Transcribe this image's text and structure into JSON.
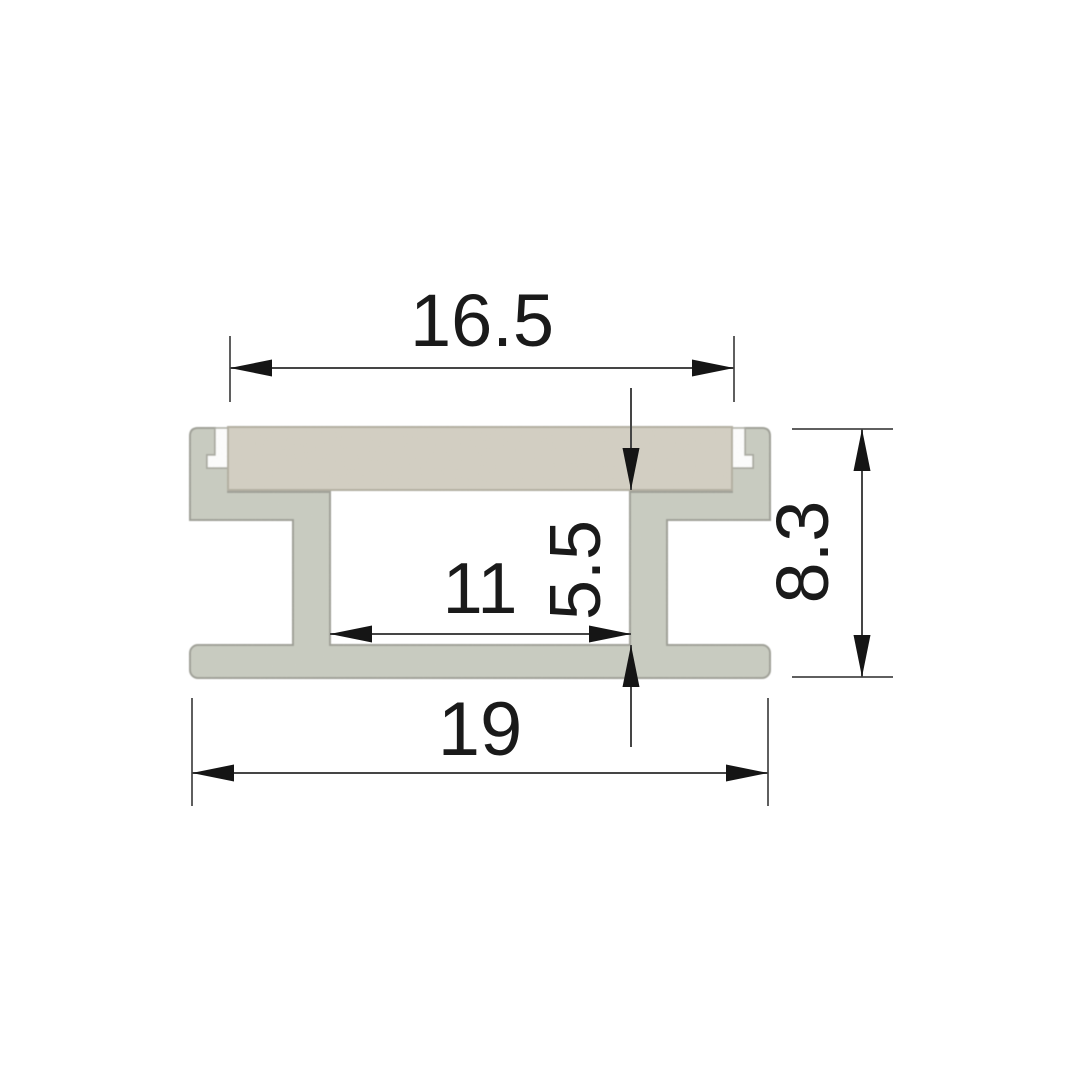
{
  "drawing": {
    "title": "Aluminium LED profile cross-section drawing",
    "dimensions": [
      {
        "id": "top-opening-width",
        "value": "16.5",
        "orientation": "horizontal"
      },
      {
        "id": "inner-channel-width",
        "value": "11",
        "orientation": "horizontal"
      },
      {
        "id": "inner-channel-height",
        "value": "5.5",
        "orientation": "vertical"
      },
      {
        "id": "overall-height",
        "value": "8.3",
        "orientation": "vertical"
      },
      {
        "id": "overall-width",
        "value": "19",
        "orientation": "horizontal"
      }
    ],
    "colors": {
      "aluminum": "#c9ccc1",
      "cover_plate": "#d3cfc2",
      "slot_gap": "#ffffff",
      "outline": "#9c9d94",
      "dimension_line": "#454545",
      "extension_line": "#5f5f5f",
      "arrow": "#151515",
      "text": "#1a1a1a",
      "background": "#ffffff"
    }
  }
}
